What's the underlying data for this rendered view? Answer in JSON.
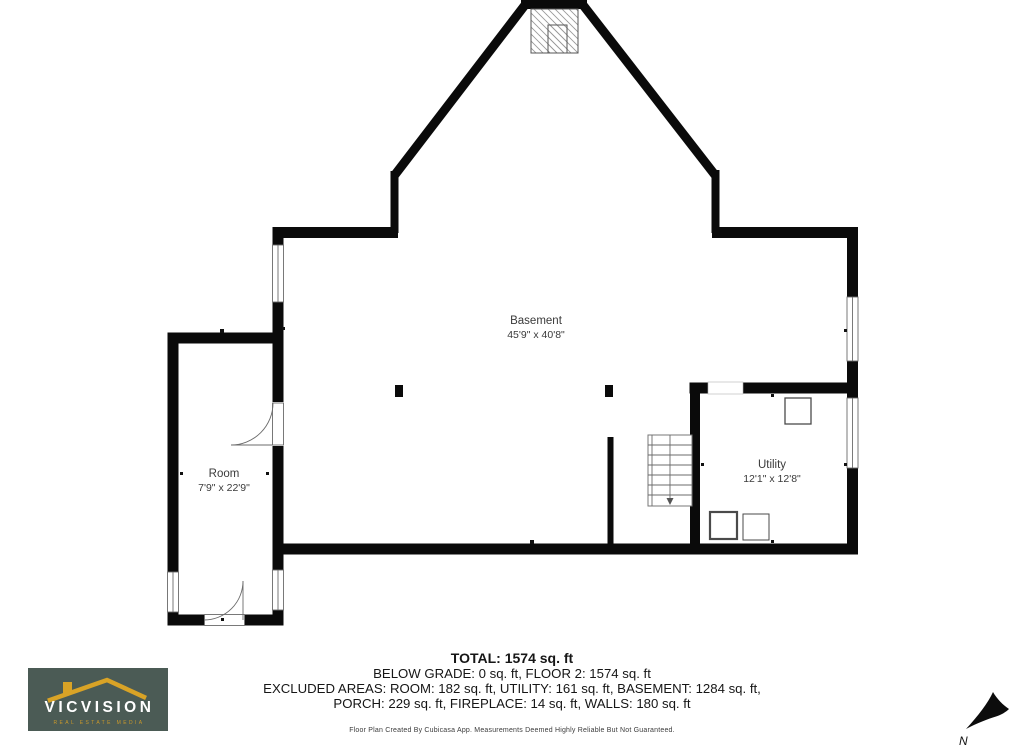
{
  "plan": {
    "rooms": {
      "basement": {
        "name": "Basement",
        "dims": "45'9\" x 40'8\""
      },
      "room": {
        "name": "Room",
        "dims": "7'9\" x 22'9\""
      },
      "utility": {
        "name": "Utility",
        "dims": "12'1\" x 12'8\""
      }
    },
    "icons": {
      "fireplace": "hatched-square",
      "stairs": "treads-with-down-arrow",
      "water_heater": "square-outline",
      "washer": "square-outline",
      "dryer": "square-outline"
    }
  },
  "summary": {
    "total": "TOTAL: 1574 sq. ft",
    "line2": "BELOW GRADE: 0 sq. ft, FLOOR 2: 1574 sq. ft",
    "line3": "EXCLUDED AREAS: ROOM: 182 sq. ft, UTILITY: 161 sq. ft, BASEMENT: 1284 sq. ft,",
    "line4": "PORCH: 229 sq. ft, FIREPLACE: 14 sq. ft, WALLS: 180 sq. ft",
    "disclaimer": "Floor Plan Created By Cubicasa App. Measurements Deemed Highly Reliable But Not Guaranteed."
  },
  "branding": {
    "name": "VICVISION",
    "tagline": "REAL ESTATE MEDIA",
    "colors": {
      "background": "#4b5b55",
      "accent_gold": "#d9a326",
      "text": "#ffffff"
    }
  },
  "compass": {
    "label": "N"
  },
  "colors": {
    "walls": "#0a0a0a",
    "labels": "#3a3a3a",
    "page_background": "#ffffff"
  }
}
